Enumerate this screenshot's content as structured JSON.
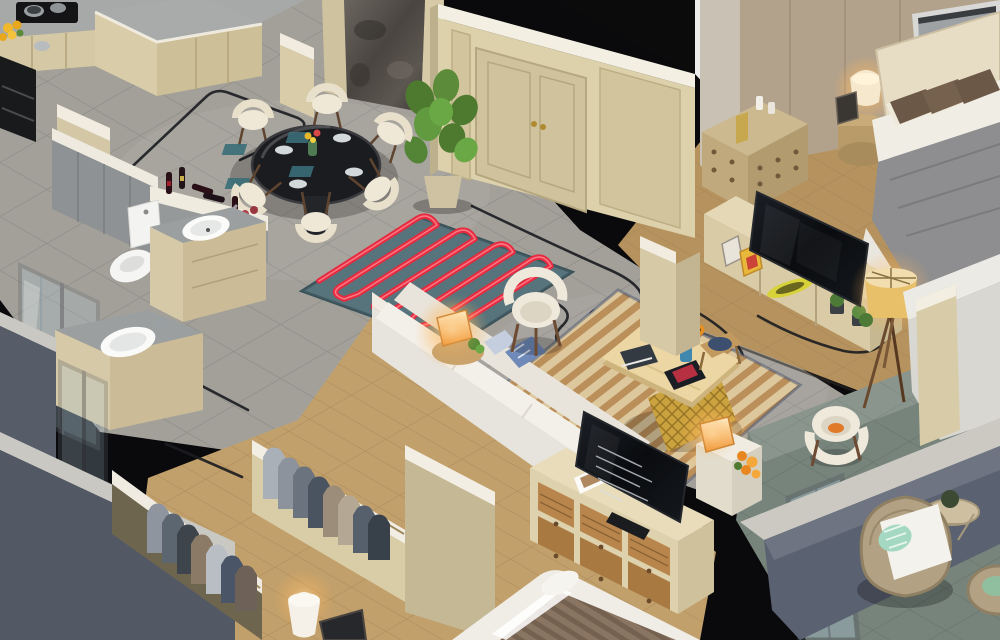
{
  "scene": {
    "type": "3d-isometric-apartment-cutaway-render",
    "render_style": "photorealistic isometric floor-plan with cutaway walls and exposed cable routing",
    "rooms": [
      {
        "id": "kitchen",
        "label": "Kitchen",
        "items": [
          "gray marble counters",
          "cream cabinets",
          "black range hood and oven",
          "gas cooktop with pots",
          "yellow flowers"
        ]
      },
      {
        "id": "dining-area",
        "label": "Dining Area",
        "items": [
          "round black glass table",
          "six cream shell chairs",
          "place settings on teal mats",
          "flower centerpiece",
          "monstera plant",
          "wine bottles on half wall"
        ]
      },
      {
        "id": "entry",
        "label": "Entry",
        "items": [
          "beige paneled double door with brass handles",
          "dark marble feature wall"
        ]
      },
      {
        "id": "underfloor-heating",
        "label": "Underfloor Heating Mat",
        "items": [
          "teal insulation mat",
          "red serpentine heating pipe"
        ]
      },
      {
        "id": "bathroom",
        "label": "Bathroom",
        "items": [
          "toilet",
          "stone-top vanity with round basin",
          "glass shower enclosure",
          "second vanity with oval basin",
          "gray tiled walls"
        ]
      },
      {
        "id": "walk-in-closet",
        "label": "Walk-in Closet",
        "items": [
          "two rails of hanging suits",
          "white-capped partition walls"
        ]
      },
      {
        "id": "second-bedroom",
        "label": "Second Bedroom",
        "items": [
          "bed with brown striped throw",
          "white table lamp",
          "dark picture frame",
          "oak plank floor"
        ]
      },
      {
        "id": "living-room",
        "label": "Living Room",
        "items": [
          "L-shaped white sofa",
          "blue patterned pillows",
          "striped rug",
          "wood coffee table with gold lattice base",
          "sunflowers in blue vase",
          "books and tablet",
          "white shell armchairs",
          "glowing cube lamps",
          "TV on six-drawer console",
          "black power cables on floor"
        ]
      },
      {
        "id": "master-bedroom",
        "label": "Master Bedroom",
        "items": [
          "double bed with gray throw and brown pillows",
          "upholstered headboard",
          "panoramic framed artwork",
          "wood dresser with candles",
          "round nightstand with lit lamp",
          "TV on light-wood media console",
          "tripod floor lamp with yellow shade",
          "succulents",
          "foot bench"
        ]
      },
      {
        "id": "balcony",
        "label": "Balcony",
        "items": [
          "rattan armchair with white cushion",
          "mint striped pillow",
          "rattan side table with plant",
          "glass railing",
          "white concrete parapet",
          "green stone tile floor"
        ]
      }
    ],
    "palette": {
      "wall_cream": "#d6caa6",
      "wall_cap_white": "#f1ece0",
      "tile_gray": "#a3a09a",
      "wood_oak": "#c2a06c",
      "stone_green": "#77847c",
      "exterior_slate": "#565d69",
      "heating_pipe_red": "#e62b3f",
      "heating_mat_teal": "#4f6d77",
      "sofa_white": "#efece6",
      "accent_blue": "#6f89b8",
      "lamp_glow_amber": "#f3a54a",
      "tv_black": "#101215"
    }
  }
}
